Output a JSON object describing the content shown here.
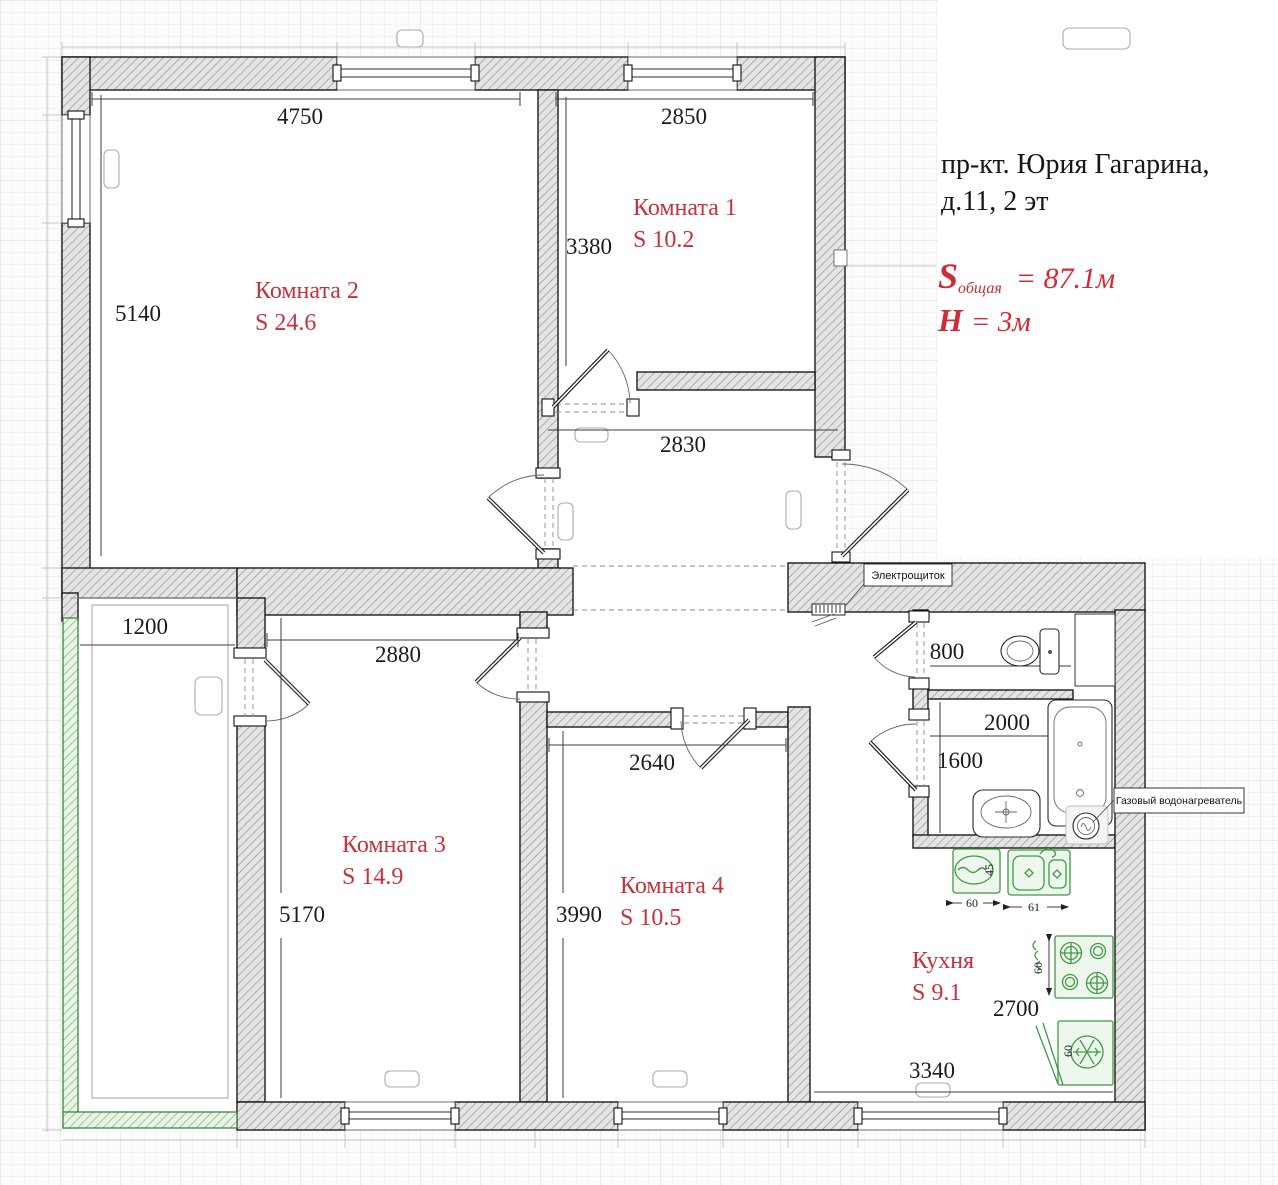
{
  "document": {
    "address_line1": "пр-кт. Юрия Гагарина,",
    "address_line2": "д.11, 2 эт",
    "total_area": {
      "symbol": "S",
      "subscript": "общая",
      "value": "= 87.1м"
    },
    "ceiling_height": {
      "symbol": "H",
      "value": "= 3м"
    }
  },
  "rooms": [
    {
      "name": "Комната 1",
      "area": "S 10.2"
    },
    {
      "name": "Комната 2",
      "area": "S 24.6"
    },
    {
      "name": "Комната 3",
      "area": "S 14.9"
    },
    {
      "name": "Комната 4",
      "area": "S 10.5"
    },
    {
      "name": "Кухня",
      "area": "S 9.1"
    }
  ],
  "dimensions_mm": {
    "room2_width": "4750",
    "room2_depth": "5140",
    "room1_width": "2850",
    "room1_depth": "3380",
    "hallway_width": "2830",
    "balcony_width": "1200",
    "room3_width": "2880",
    "room3_depth": "5170",
    "room4_width": "2640",
    "room4_depth": "3990",
    "wc_width": "800",
    "bathroom_width": "2000",
    "bathroom_depth": "1600",
    "kitchen_depth": "2700",
    "kitchen_width": "3340"
  },
  "fixtures": {
    "electrical_panel_label": "Электрощиток",
    "gas_heater_label": "Газовый водонагреватель",
    "washer_width_cm": "60",
    "kitchen_sink_width_cm": "61",
    "washer_depth_cm": "45",
    "stove_width_cm": "60",
    "fridge_width_cm": "60"
  },
  "colors": {
    "annotation_red": "#c5323e",
    "wall_hatch_gray": "#8b8b8b",
    "balcony_green": "#3f9b41",
    "dimension_black": "#1c1c1c"
  }
}
